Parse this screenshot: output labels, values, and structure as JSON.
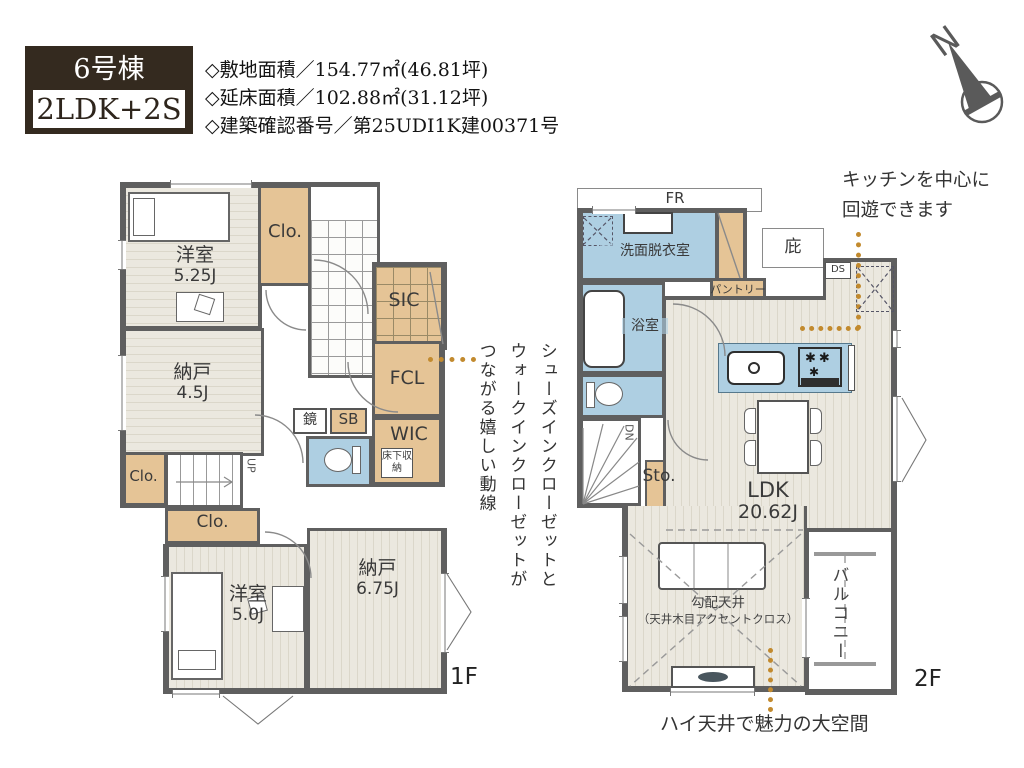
{
  "header": {
    "unit": "6号棟",
    "plan_type": "2LDK+2S",
    "specs": [
      "◇敷地面積／154.77㎡(46.81坪)",
      "◇延床面積／102.88㎡(31.12坪)",
      "◇建築確認番号／第25UDI1K建00371号"
    ]
  },
  "compass": {
    "north": "N"
  },
  "floor1": {
    "label": "1F",
    "rooms": {
      "bedroom_525": {
        "name": "洋室",
        "size": "5.25J"
      },
      "closet_top": "Clo.",
      "sic": "SIC",
      "fcl": "FCL",
      "mirror": "鏡",
      "sb": "SB",
      "wic": "WIC",
      "underfloor": "床下収納",
      "storage_45": {
        "name": "納戸",
        "size": "4.5J"
      },
      "closet_left": "Clo.",
      "closet_mid": "Clo.",
      "bedroom_50": {
        "name": "洋室",
        "size": "5.0J"
      },
      "storage_675": {
        "name": "納戸",
        "size": "6.75J"
      },
      "stairs_up": "UP"
    }
  },
  "floor2": {
    "label": "2F",
    "rooms": {
      "fr": "FR",
      "washroom": "洗面脱衣室",
      "canopy": "庇",
      "pantry": "パントリー",
      "ds": "DS",
      "bathroom": "浴室",
      "stairs_down": "DN",
      "storage": "Sto.",
      "ldk": {
        "name": "LDK",
        "size": "20.62J"
      },
      "sloped_ceiling": "勾配天井",
      "sloped_ceiling_note": "（天井木目アクセントクロス）",
      "balcony": "バルコニー"
    }
  },
  "annotations": {
    "closet_flow": [
      "シューズインクローゼットと",
      "ウォークインクローゼットが",
      "つながる嬉しい動線"
    ],
    "kitchen_line1": "キッチンを中心に",
    "kitchen_line2": "回遊できます",
    "high_ceiling": "ハイ天井で魅力の大空間"
  },
  "colors": {
    "accent_dots": "#c28a2e",
    "closet_tan": "#e5c496",
    "wet_blue": "#aecfe2",
    "wall": "#5f5f5f",
    "title_bg": "#342a1f"
  }
}
